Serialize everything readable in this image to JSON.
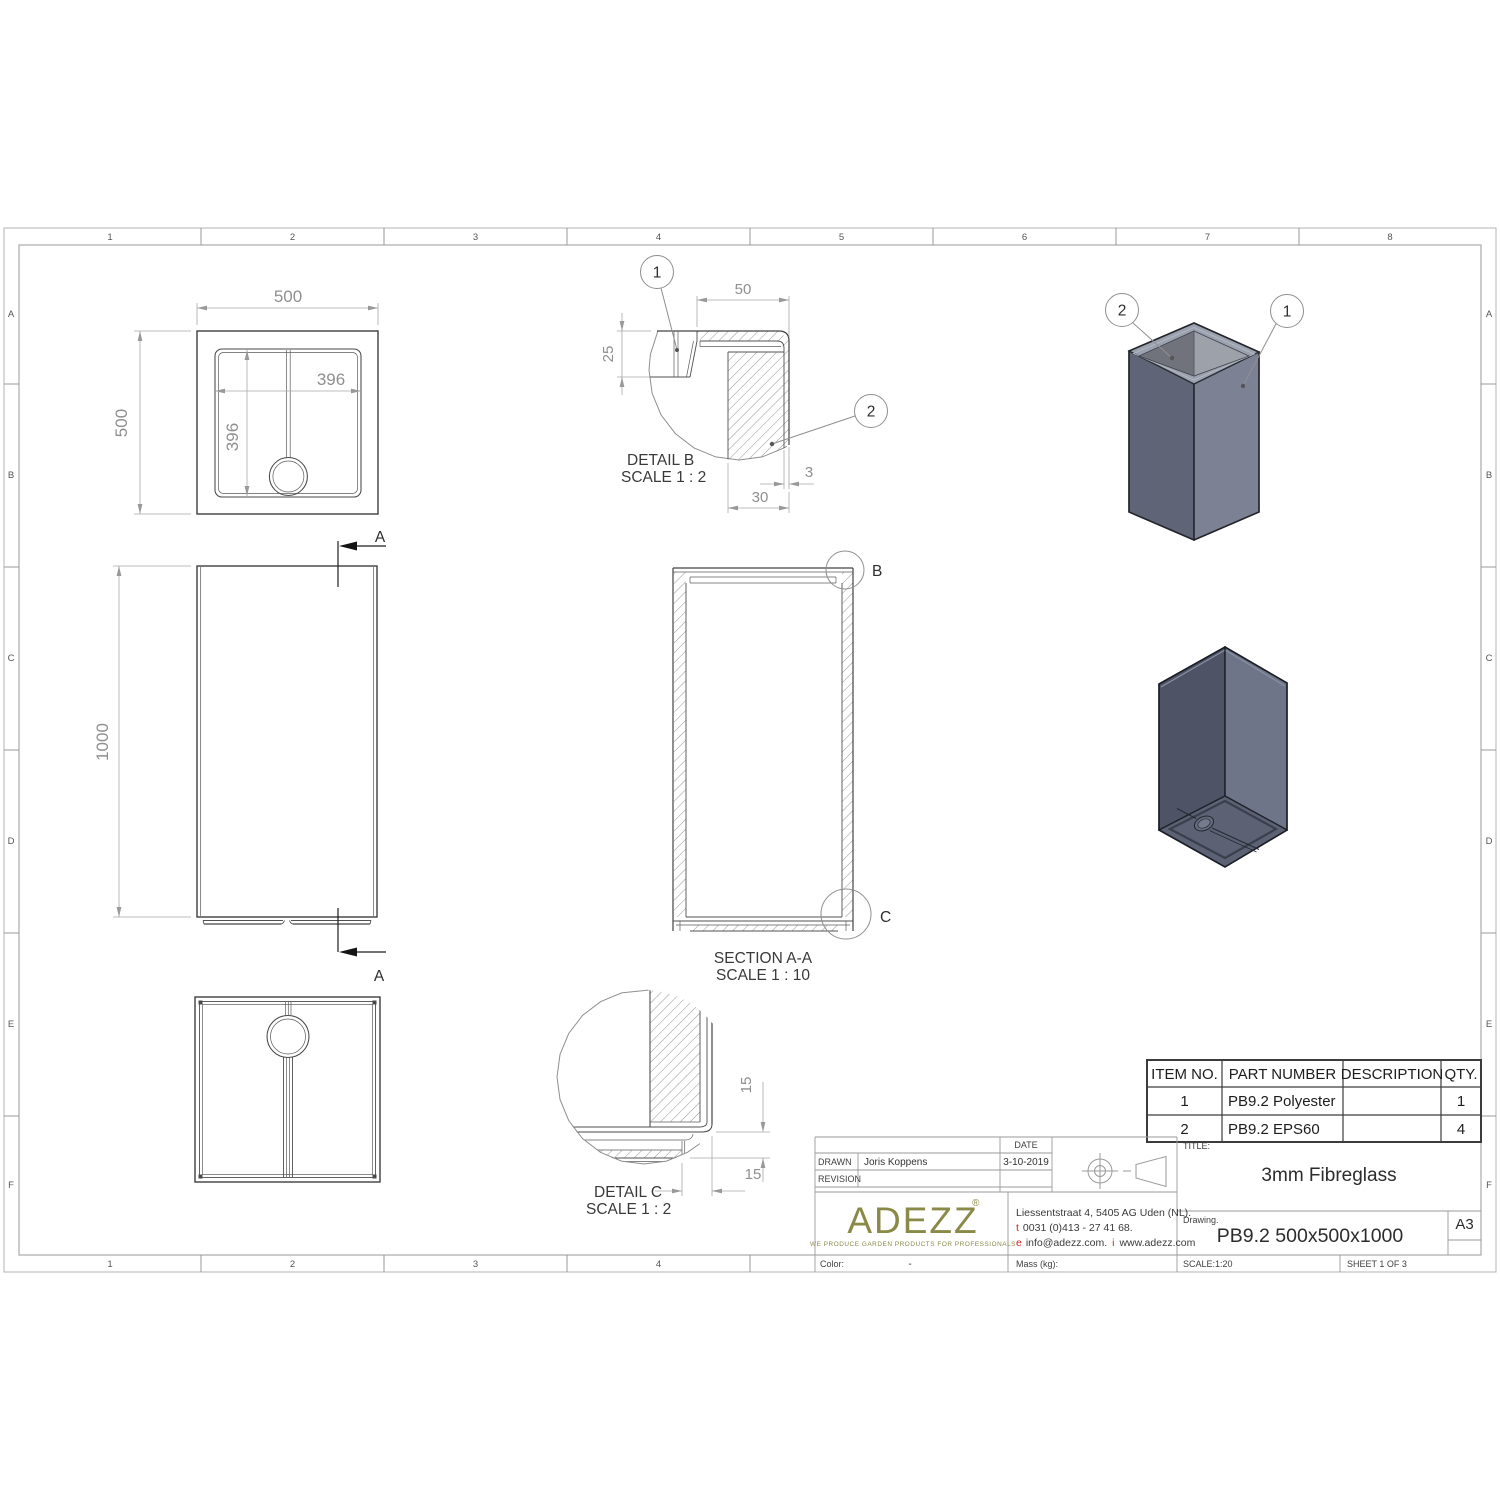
{
  "frame": {
    "cols": [
      "1",
      "2",
      "3",
      "4",
      "5",
      "6",
      "7",
      "8"
    ],
    "cols_bottom": [
      "1",
      "2",
      "3",
      "4"
    ],
    "rows": [
      "A",
      "B",
      "C",
      "D",
      "E",
      "F"
    ]
  },
  "views": {
    "top_view": {
      "dim_width": "500",
      "dim_height": "500",
      "dim_inner_width": "396",
      "dim_inner_height": "396"
    },
    "front_view": {
      "dim_height": "1000",
      "section_label_top": "A",
      "section_label_bottom": "A"
    },
    "detail_b": {
      "title": "DETAIL B",
      "scale": "SCALE 1 : 2",
      "dim_flange": "50",
      "dim_lip": "25",
      "dim_shell": "3",
      "dim_wall": "30",
      "callout_shell": "1",
      "callout_foam": "2"
    },
    "section_aa": {
      "title": "SECTION A-A",
      "scale": "SCALE 1 : 10",
      "detail_b_marker": "B",
      "detail_c_marker": "C"
    },
    "detail_c": {
      "title": "DETAIL C",
      "scale": "SCALE 1 : 2",
      "dim_foot_height": "15",
      "dim_foot_width": "15"
    },
    "iso_top": {
      "callout_shell": "1",
      "callout_foam": "2"
    }
  },
  "bom": {
    "headers": [
      "ITEM NO.",
      "PART NUMBER",
      "DESCRIPTION",
      "QTY."
    ],
    "rows": [
      {
        "item": "1",
        "part": "PB9.2 Polyester",
        "description": "",
        "qty": "1"
      },
      {
        "item": "2",
        "part": "PB9.2 EPS60",
        "description": "",
        "qty": "4"
      }
    ]
  },
  "title_block": {
    "date_label": "DATE",
    "date_value": "3-10-2019",
    "drawn_label": "DRAWN",
    "drawn_value": "Joris Koppens",
    "revision_label": "REVISION",
    "logo": {
      "name": "ADEZZ",
      "registered": "®",
      "tagline": "WE PRODUCE GARDEN PRODUCTS FOR PROFESSIONALS"
    },
    "address": {
      "line1": "Liessentstraat 4, 5405 AG Uden (NL).",
      "phone_prefix": "t",
      "phone": "0031 (0)413 - 27 41 68.",
      "email_prefix": "e",
      "email": "info@adezz.com.",
      "web_prefix": "i",
      "website": "www.adezz.com"
    },
    "title_label": "TITLE:",
    "title_value": "3mm Fibreglass",
    "drawing_label": "Drawing.",
    "drawing_value": "PB9.2 500x500x1000",
    "paper_size": "A3",
    "color_label": "Color:",
    "color_value": "-",
    "mass_label": "Mass (kg):",
    "scale_text": "SCALE:1:20",
    "sheet_text": "SHEET 1 OF 3"
  },
  "colors": {
    "line_dark": "#3e3e3e",
    "dim_gray": "#8f8f8f",
    "logo_olive": "#8a8a48",
    "accent_red": "#c92121",
    "iso_left_face": "#5f6476",
    "iso_right_face": "#7c8294",
    "iso_rim": "#9ba1ae",
    "iso_bottom_left": "#4e5365",
    "iso_bottom_right": "#6f7589",
    "iso_bottom_face": "#5c6173"
  }
}
